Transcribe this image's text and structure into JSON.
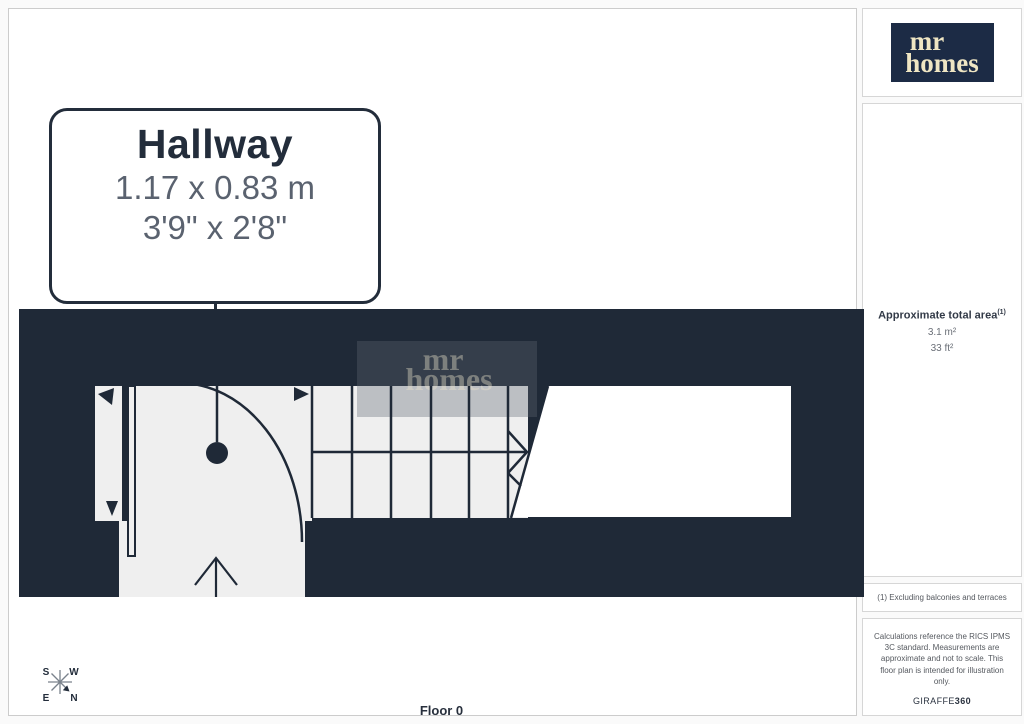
{
  "callout": {
    "room": "Hallway",
    "metric": "1.17 x 0.83 m",
    "imperial": "3'9\" x 2'8\""
  },
  "floor_label": "Floor 0",
  "compass": {
    "n": "N",
    "s": "S",
    "e": "E",
    "w": "W"
  },
  "logo": {
    "line1": "mr",
    "line2": "homes"
  },
  "watermark": {
    "line1": "mr",
    "line2": "homes"
  },
  "sidebar": {
    "area": {
      "label": "Approximate total area",
      "sup": "(1)",
      "metric": "3.1 m²",
      "imperial": "33 ft²"
    },
    "footnote": "(1) Excluding balconies and terraces",
    "disclaimer": "Calculations reference the RICS IPMS 3C standard. Measurements are approximate and not to scale. This floor plan is intended for illustration only.",
    "brand_name": "GIRAFFE",
    "brand_suffix": "360"
  },
  "colors": {
    "wall_navy": "#1f2937",
    "logo_navy": "#1c2b45",
    "logo_cream": "#efe6c3",
    "floor_light": "#efefef",
    "dim_text_gray": "#5a626f",
    "note_gray": "#55595f"
  }
}
